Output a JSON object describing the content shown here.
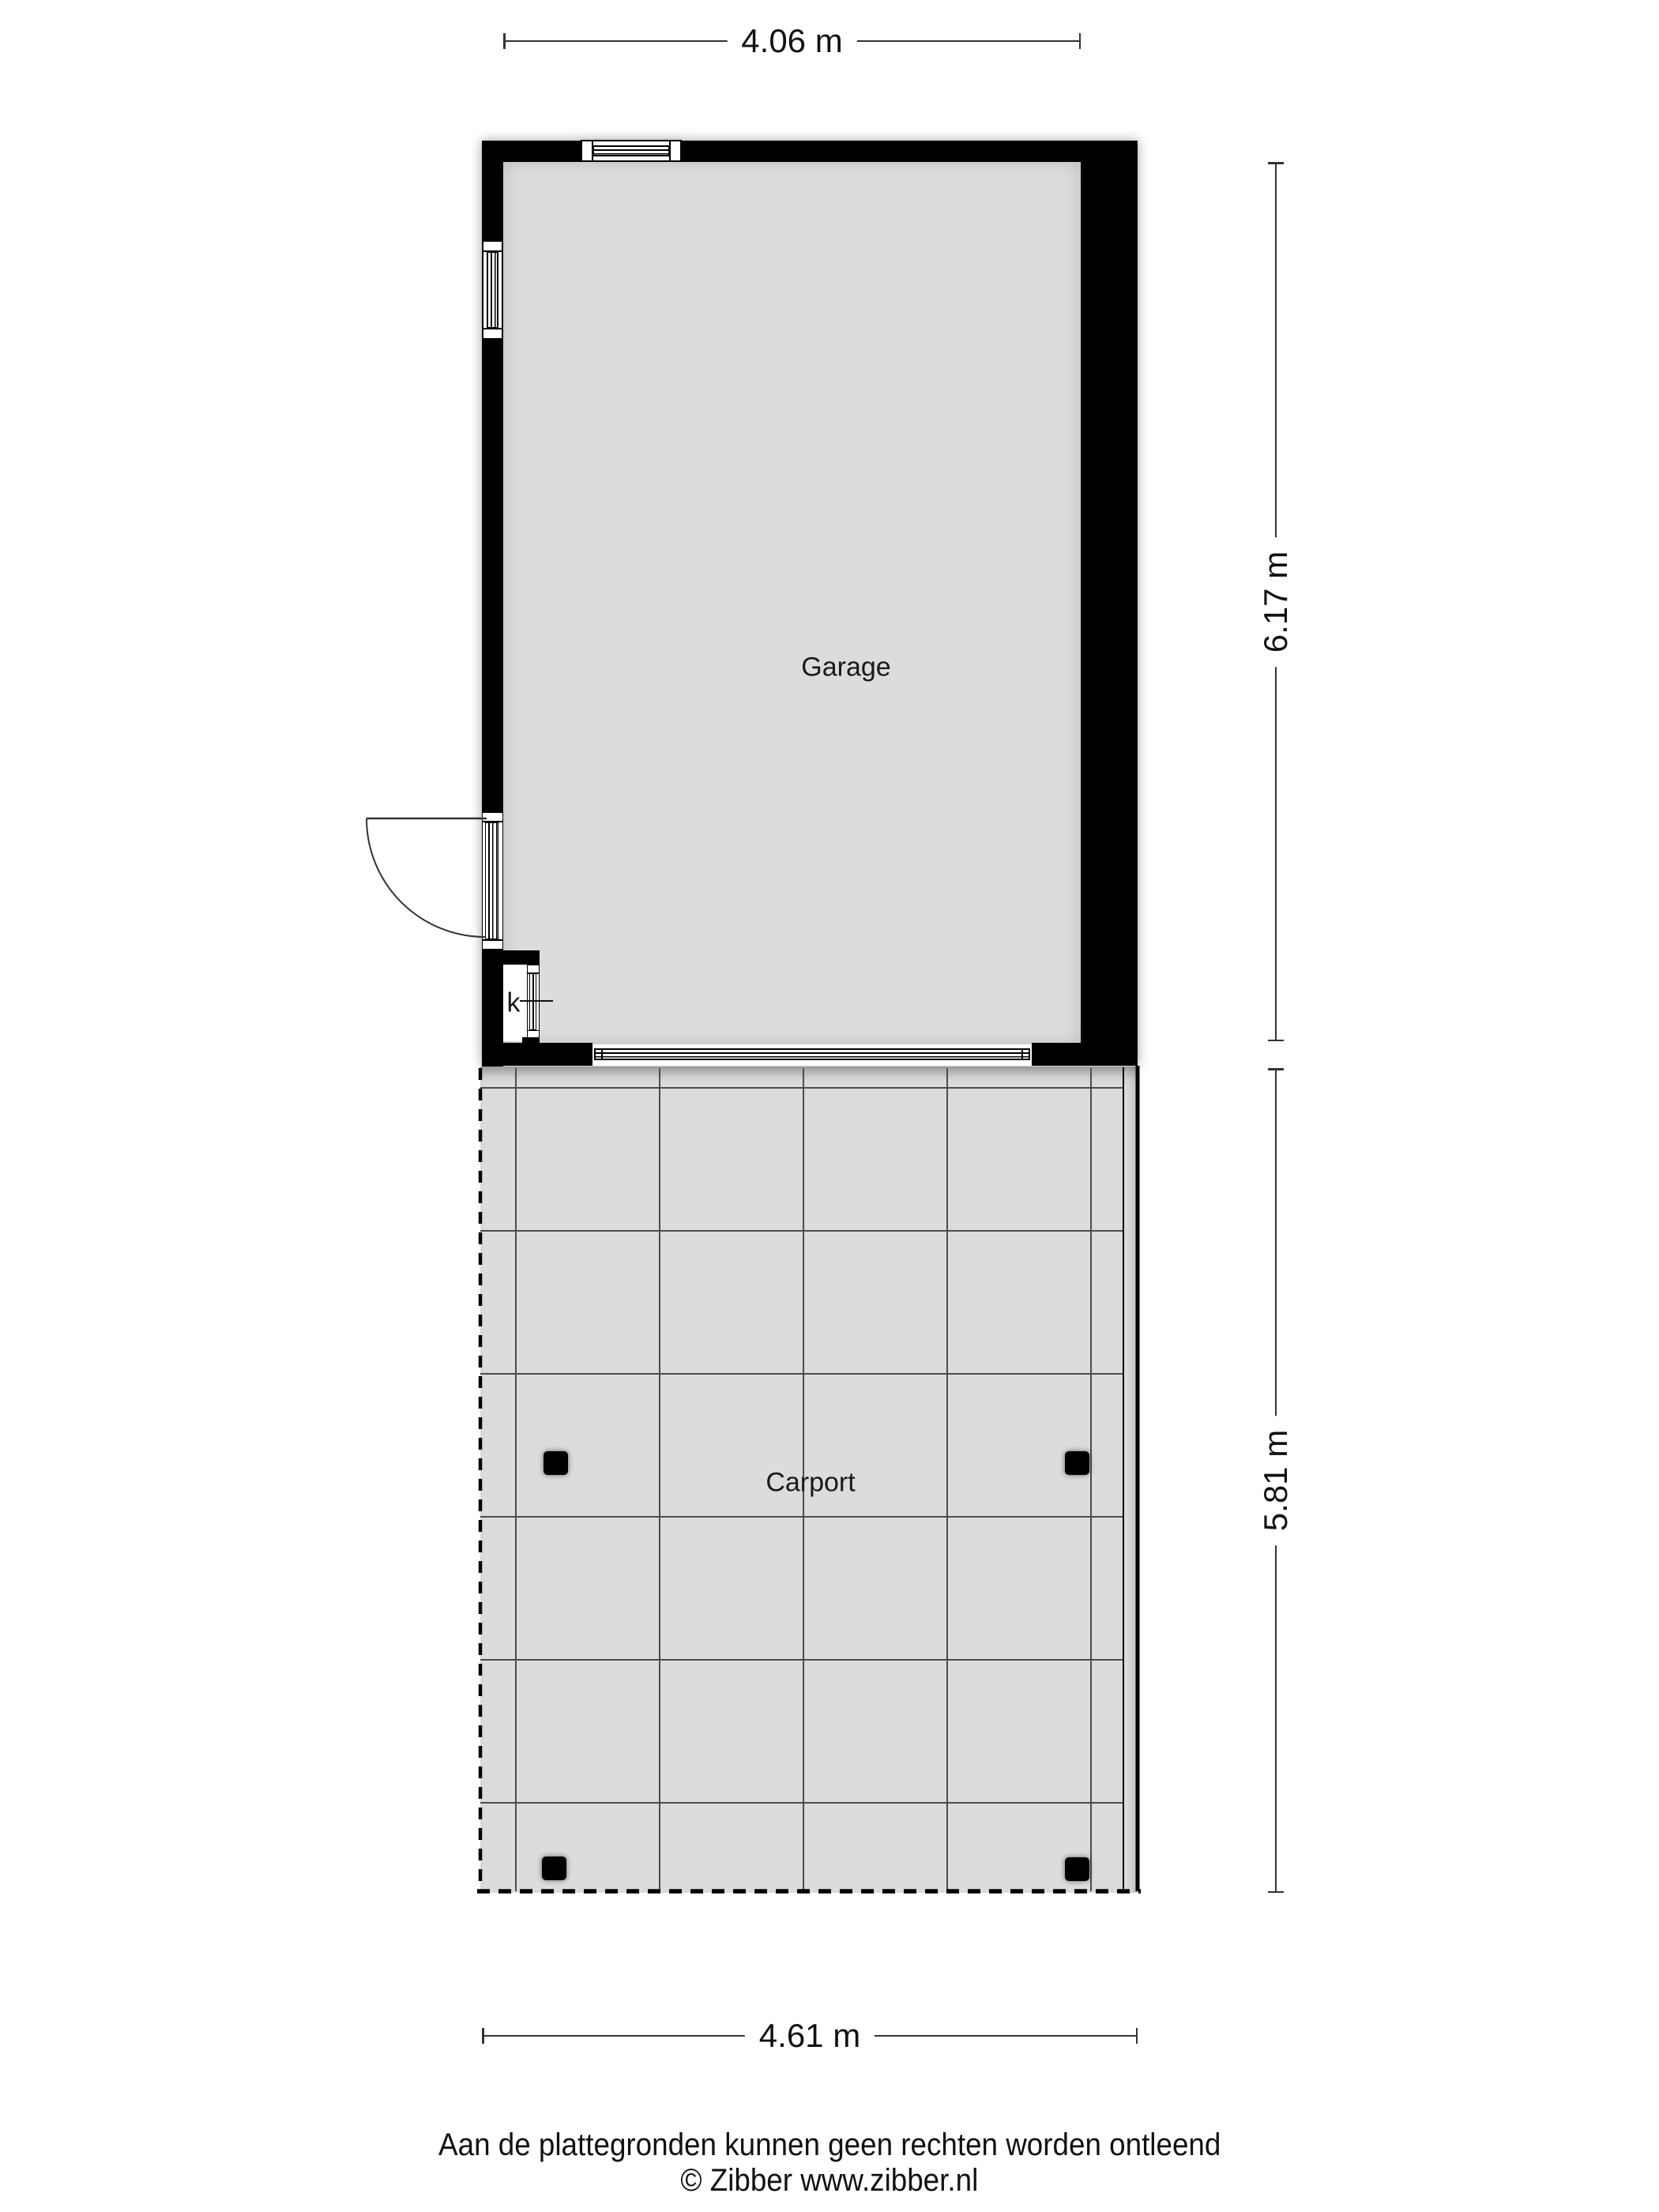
{
  "rooms": {
    "garage": "Garage",
    "carport": "Carport",
    "closet": "k"
  },
  "dimensions": {
    "garage_width": "4.06 m",
    "garage_height": "6.17 m",
    "carport_height": "5.81 m",
    "carport_width": "4.61 m"
  },
  "footer": {
    "disclaimer": "Aan de plattegronden kunnen geen rechten worden ontleend",
    "copyright": "© Zibber www.zibber.nl"
  },
  "colors": {
    "wall": "#000000",
    "floor": "#dcdcdc",
    "grid_line": "#4d4d4d",
    "dimension_line": "#333333",
    "background": "#ffffff"
  }
}
